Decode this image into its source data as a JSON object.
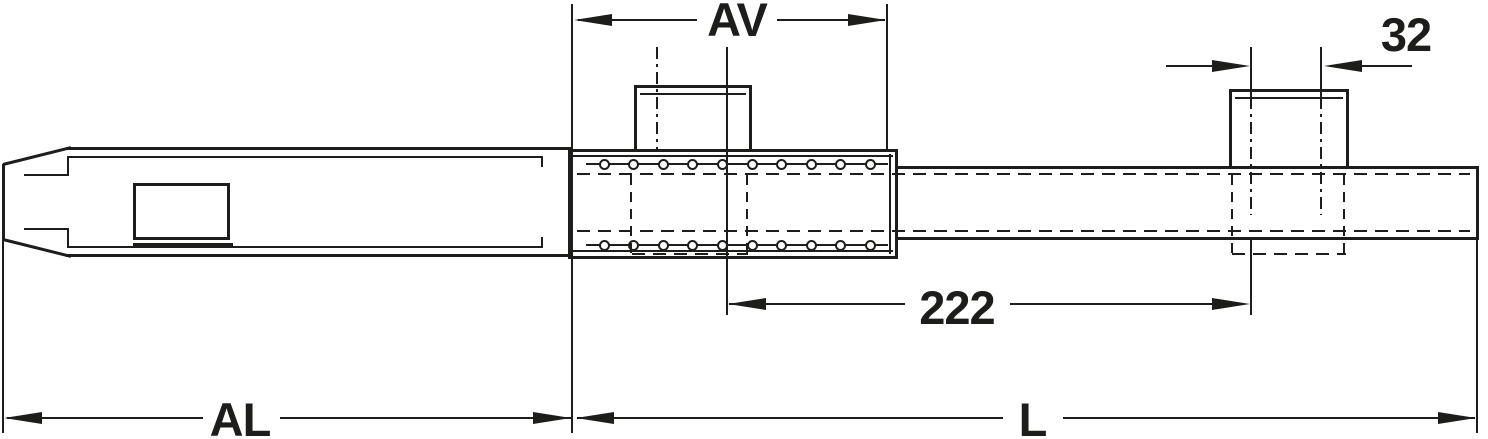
{
  "drawing": {
    "background": "#ffffff",
    "line_color": "#1d1d1b",
    "dimensions": {
      "av": {
        "label": "AV"
      },
      "hole_pitch": {
        "label": "32"
      },
      "block_distance": {
        "label": "222"
      },
      "al": {
        "label": "AL"
      },
      "l": {
        "label": "L"
      }
    },
    "holes": {
      "count_per_row": 10,
      "start_x": 604,
      "spacing": 29.6,
      "top_y": 164,
      "bottom_y": 245,
      "diameter": 11
    }
  }
}
